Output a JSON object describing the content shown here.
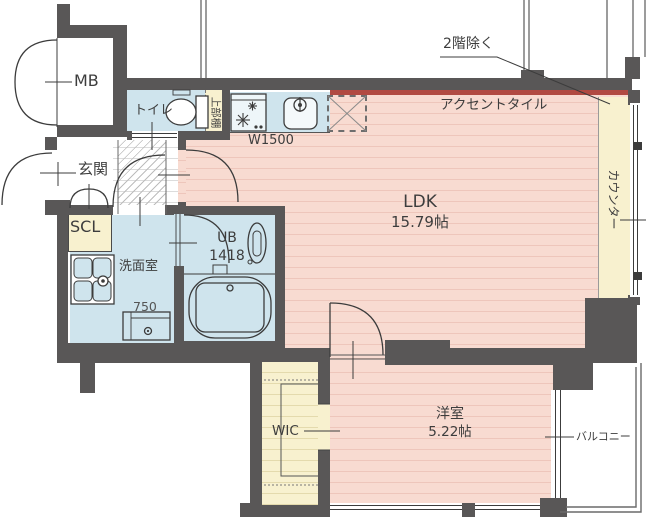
{
  "title": "マンション間取り図",
  "rooms": {
    "mb": {
      "label": "MB"
    },
    "toilet": {
      "label": "トイレ"
    },
    "upper_shelf": {
      "label": "上部棚"
    },
    "entrance": {
      "label": "玄関"
    },
    "shoe_closet": {
      "label": "SCL"
    },
    "washroom": {
      "label": "洗面室"
    },
    "unit_bath": {
      "label": "UB",
      "size": "1418"
    },
    "ldk": {
      "label": "LDK",
      "size": "15.79帖"
    },
    "bedroom": {
      "label": "洋室",
      "size": "5.22帖"
    },
    "wic": {
      "label": "WIC"
    },
    "counter": {
      "label": "カウンター"
    },
    "balcony": {
      "label": "バルコニー"
    }
  },
  "annotations": {
    "excluding_2f": "2階除く",
    "accent_tile": "アクセントタイル",
    "kitchen_width": "W1500",
    "vanity_width": "750"
  },
  "colors": {
    "wall": "#595757",
    "flooring": "#f8dbd1",
    "flooring_stripe": "#eec6bb",
    "wet_area": "#cfe4ed",
    "storage": "#f8f1cf",
    "accent_tile": "#b14a42"
  }
}
